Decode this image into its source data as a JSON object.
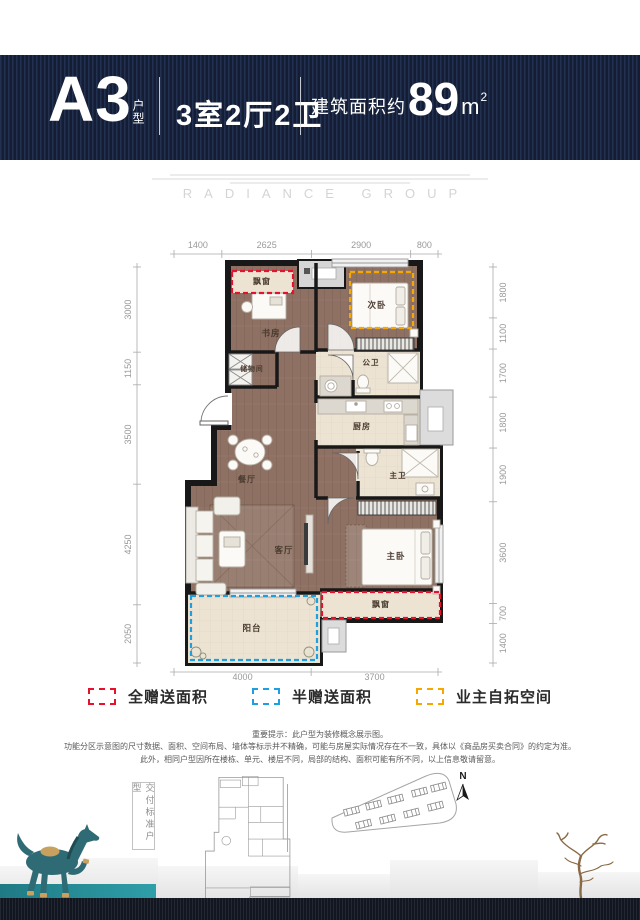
{
  "header": {
    "unit_code": "A3",
    "unit_suffix": "户型",
    "layout": "3室2厅2卫",
    "area_prefix": "建筑面积约",
    "area_value": "89",
    "area_unit_base": "m",
    "area_unit_sup": "2"
  },
  "watermark": {
    "brand": "RADIANCE GROUP"
  },
  "plan": {
    "dimensions": {
      "top": [
        1400,
        2625,
        2900,
        800
      ],
      "left": [
        3000,
        1150,
        3500,
        4250,
        2050
      ],
      "right": [
        1800,
        1100,
        1700,
        1800,
        1900,
        3600,
        700,
        1400
      ],
      "bottom": [
        4000,
        3700
      ]
    },
    "rooms": [
      {
        "label": "飘窗"
      },
      {
        "label": "次卧"
      },
      {
        "label": "书房"
      },
      {
        "label": "储物间"
      },
      {
        "label": "公卫"
      },
      {
        "label": "厨房"
      },
      {
        "label": "餐厅"
      },
      {
        "label": "主卫"
      },
      {
        "label": "客厅"
      },
      {
        "label": "主卧"
      },
      {
        "label": "阳台"
      },
      {
        "label": "飘窗"
      }
    ]
  },
  "legend": [
    {
      "label": "全赠送面积",
      "color": "#e8112d"
    },
    {
      "label": "半赠送面积",
      "color": "#1e9fe0"
    },
    {
      "label": "业主自拓空间",
      "color": "#f5a800"
    }
  ],
  "disclaimer": {
    "line1": "重要提示：此户型为装修概念展示图。",
    "line2": "功能分区示意图的尺寸数据、面积、空间布局、墙体等标示并不精确，可能与房屋实际情况存在不一致，具体以《商品房买卖合同》的约定为准。",
    "line3": "此外，相同户型因所在楼栋、单元、楼层不同，局部的结构、面积可能有所不同，以上信息敬请留意。"
  },
  "footer": {
    "standard_label": "交付标准户型",
    "compass": "N"
  }
}
